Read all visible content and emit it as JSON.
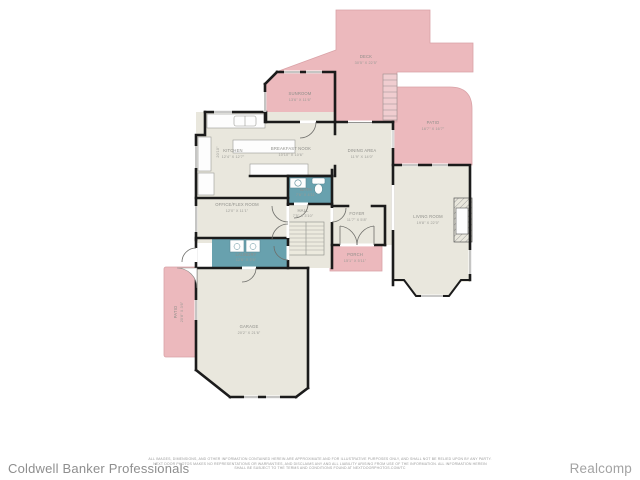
{
  "plan": {
    "rooms": {
      "deck": {
        "name": "DECK",
        "dims": "30'5\" X 22'5\""
      },
      "sunroom": {
        "name": "SUNROOM",
        "dims": "13'6\" X 11'6\""
      },
      "patio": {
        "name": "PATIO",
        "dims": "16'7\" X 16'7\""
      },
      "kitchen": {
        "name": "KITCHEN",
        "dims": "12'4\" X 12'7\"",
        "side_dim": "20'10\""
      },
      "breakfast_nook": {
        "name": "BREAKFAST NOOK",
        "dims": "10'10\" X 10'6\""
      },
      "dining_area": {
        "name": "DINING AREA",
        "dims": "11'9\" X 14'0\""
      },
      "living_room": {
        "name": "LIVING ROOM",
        "dims": "19'8\" X 22'0\""
      },
      "office": {
        "name": "OFFICE/FLEX ROOM",
        "dims": "12'0\" X 11'1\""
      },
      "bath": {
        "name": "BATH",
        "dims": "7'6\" X 4'11\""
      },
      "hall": {
        "name": "HALL",
        "dims": "7'5\" X 3'10\""
      },
      "foyer": {
        "name": "FOYER",
        "dims": "11'7\" X 5'8\""
      },
      "porch": {
        "name": "PORCH",
        "dims": "15'1\" X 5'11\""
      },
      "laundry": {
        "name": "LAUNDRY",
        "dims": "12'6\" X 5'6\""
      },
      "garage": {
        "name": "GARAGE",
        "dims": "20'2\" X 21'6\""
      },
      "side_patio": {
        "name": "PATIO",
        "dims": "20'8\" X 3'6\""
      }
    },
    "colors": {
      "exterior_pink": "#ecb9bd",
      "interior_beige": "#e9e7dd",
      "wet_room_teal": "#68a1ae",
      "wall": "#1b1b1b"
    }
  },
  "footer": {
    "brand_left": "Coldwell Banker Professionals",
    "brand_right": "Realcomp",
    "disclaimer_line1": "ALL IMAGES, DIMENSIONS, AND OTHER INFORMATION CONTAINED HEREIN ARE APPROXIMATE AND FOR ILLUSTRATIVE PURPOSES ONLY, AND SHALL NOT BE RELIED UPON BY ANY PARTY.",
    "disclaimer_line2": "NEXT DOOR PHOTOS MAKES NO REPRESENTATIONS OR WARRANTIES, AND DISCLAIMS ANY AND ALL LIABILITY ARISING FROM USE OF THE INFORMATION. ALL INFORMATION HEREIN",
    "disclaimer_line3": "SHALL BE SUBJECT TO THE TERMS AND CONDITIONS FOUND AT NEXTDOORPHOTOS.COM/TC"
  }
}
